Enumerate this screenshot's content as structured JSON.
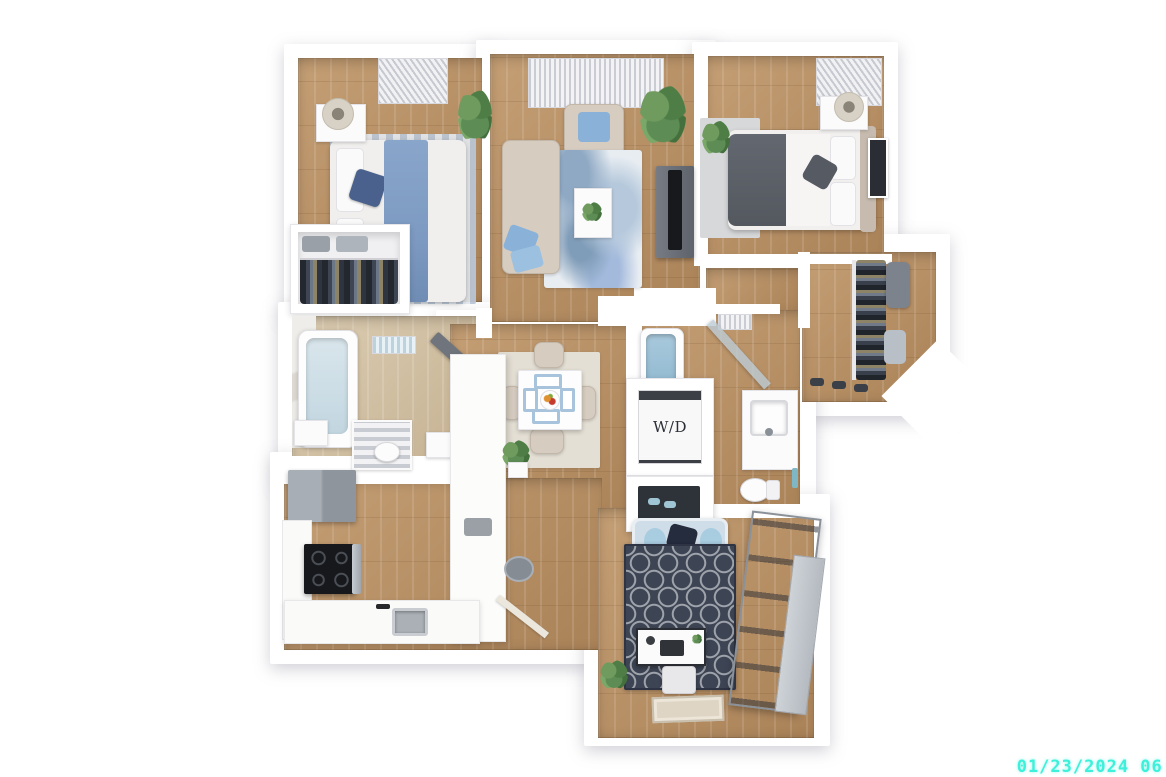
{
  "scene": {
    "type": "3d-apartment-floor-plan",
    "rooms": [
      "bedroom-1",
      "living-room",
      "bedroom-2",
      "walk-in-closet",
      "hallway",
      "bathroom-1",
      "dining-area",
      "kitchen",
      "bathroom-2",
      "laundry-closet",
      "storage-closet",
      "den-office",
      "entry"
    ]
  },
  "labels": {
    "washer_dryer": "W/D"
  },
  "watermark": {
    "text": "01/23/2024 06:",
    "color": "#3EF0DA"
  },
  "palette": {
    "background": "#FFFFFF",
    "wall": "#FFFFFF",
    "wood_floor": "#B8926A",
    "light_floor": "#D3C3A6",
    "living_rug_blue": "#8FA9C4",
    "den_rug_navy": "#3D4454",
    "bed_blue": "#7D9AC2",
    "sofa_beige": "#D6CCC0",
    "loveseat_blue": "#CFDDE8",
    "appliance_gray": "#9AA1A8",
    "plant_green": "#5E8C55",
    "watermark_cyan": "#3EF0DA"
  }
}
